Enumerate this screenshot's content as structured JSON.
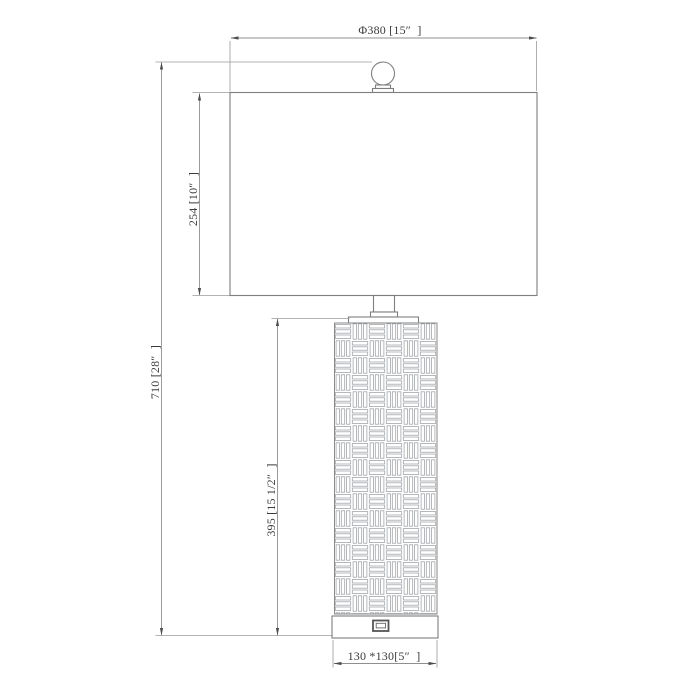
{
  "colors": {
    "background": "#ffffff",
    "outline": "#7e7e7e",
    "weave_line": "#9ba1a5",
    "dimension_line": "#8f8f8f",
    "arrow": "#4d4d4d",
    "label_text": "#3b3b3b"
  },
  "dimensions": {
    "shade_diameter": {
      "label": "Φ380 [15″  ]"
    },
    "shade_height": {
      "label": "254 [10″  ]"
    },
    "overall_height": {
      "label": "710 [28″  ]"
    },
    "body_height": {
      "label": "395 [15 1/2″  ]"
    },
    "base_footprint": {
      "label": "130 *130[5″  ]"
    }
  }
}
